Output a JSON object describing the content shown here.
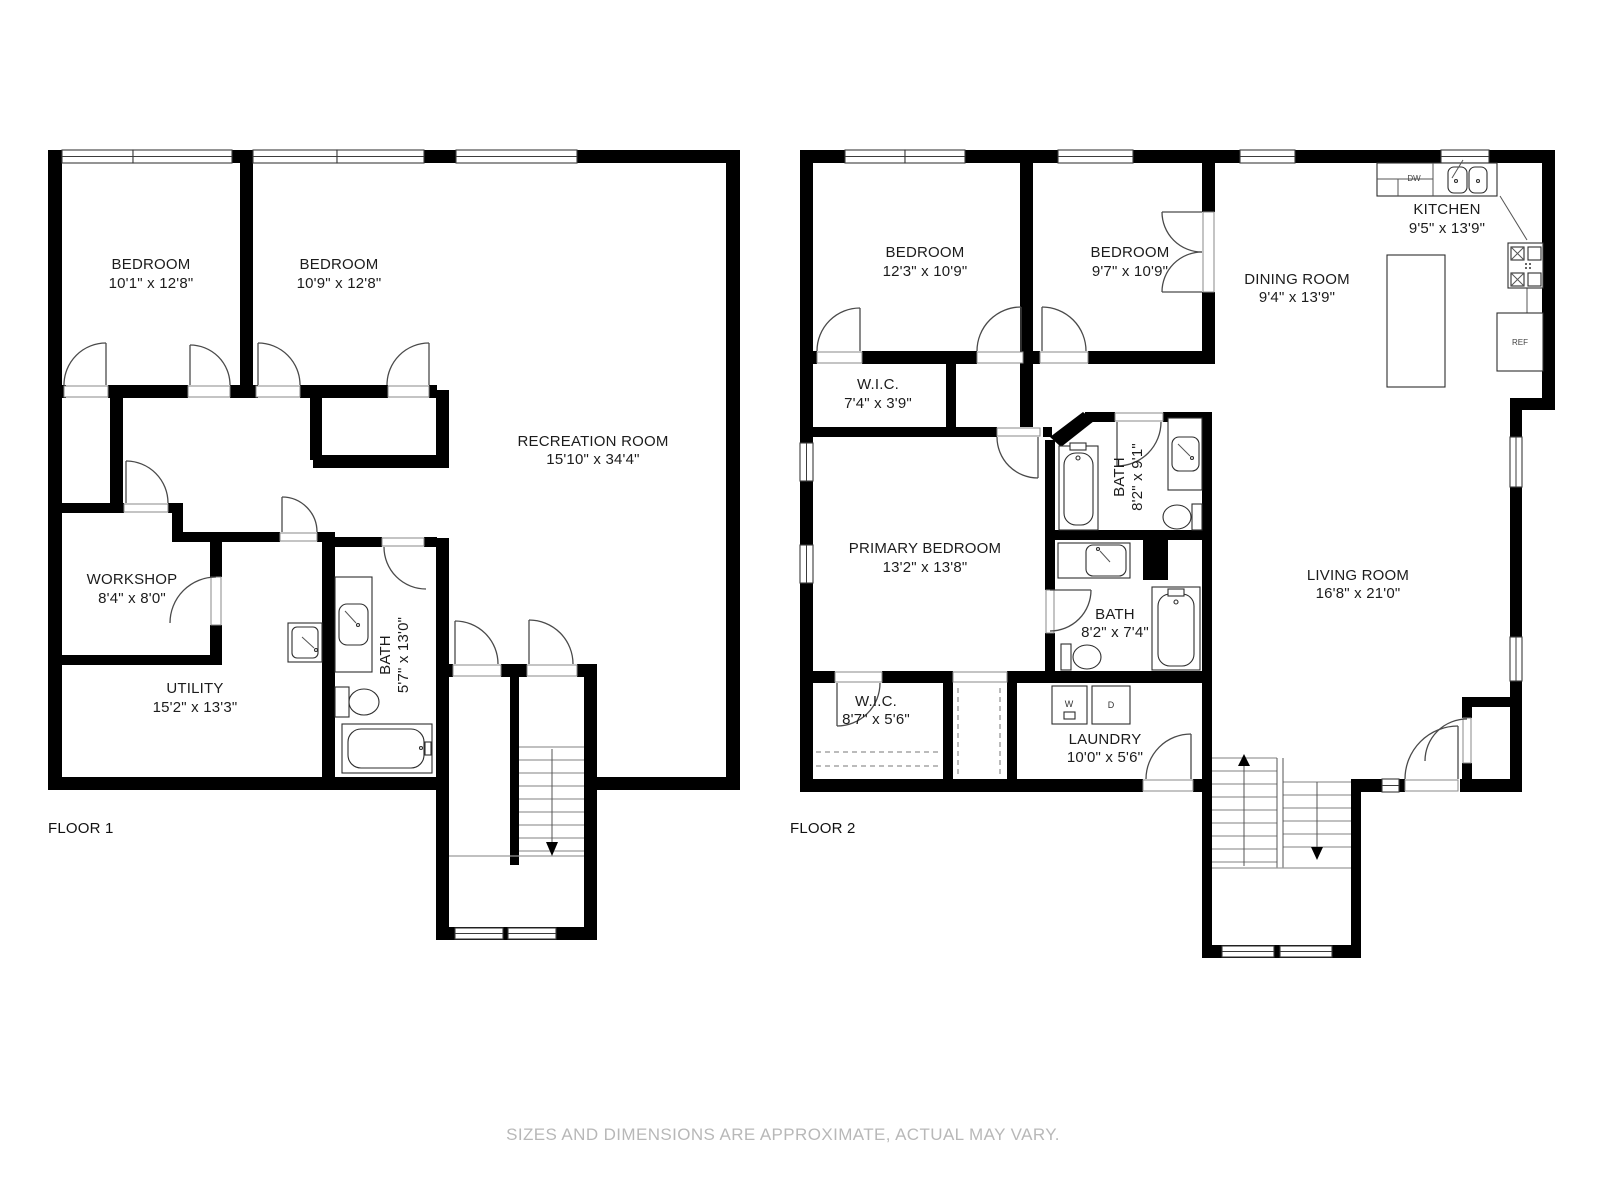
{
  "floor1": {
    "label": "FLOOR 1",
    "rooms": {
      "bedroom1": {
        "name": "BEDROOM",
        "dims": "10'1\" x 12'8\""
      },
      "bedroom2": {
        "name": "BEDROOM",
        "dims": "10'9\" x 12'8\""
      },
      "recreation": {
        "name": "RECREATION ROOM",
        "dims": "15'10\" x 34'4\""
      },
      "workshop": {
        "name": "WORKSHOP",
        "dims": "8'4\" x 8'0\""
      },
      "utility": {
        "name": "UTILITY",
        "dims": "15'2\" x 13'3\""
      },
      "bath": {
        "name": "BATH",
        "dims": "5'7\" x 13'0\""
      }
    }
  },
  "floor2": {
    "label": "FLOOR 2",
    "rooms": {
      "bedroom1": {
        "name": "BEDROOM",
        "dims": "12'3\" x 10'9\""
      },
      "bedroom2": {
        "name": "BEDROOM",
        "dims": "9'7\" x 10'9\""
      },
      "kitchen": {
        "name": "KITCHEN",
        "dims": "9'5\" x 13'9\""
      },
      "dining": {
        "name": "DINING ROOM",
        "dims": "9'4\" x 13'9\""
      },
      "wic1": {
        "name": "W.I.C.",
        "dims": "7'4\" x 3'9\""
      },
      "primary": {
        "name": "PRIMARY BEDROOM",
        "dims": "13'2\" x 13'8\""
      },
      "bath1": {
        "name": "BATH",
        "dims": "8'2\" x 9'1\""
      },
      "bath2": {
        "name": "BATH",
        "dims": "8'2\" x 7'4\""
      },
      "living": {
        "name": "LIVING ROOM",
        "dims": "16'8\" x 21'0\""
      },
      "wic2": {
        "name": "W.I.C.",
        "dims": "8'7\" x 5'6\""
      },
      "laundry": {
        "name": "LAUNDRY",
        "dims": "10'0\" x 5'6\""
      }
    }
  },
  "appliances": {
    "dishwasher": "DW",
    "refrigerator": "REF",
    "washer": "W",
    "dryer": "D"
  },
  "footer": {
    "disclaimer": "SIZES AND DIMENSIONS ARE APPROXIMATE, ACTUAL MAY VARY."
  },
  "colors": {
    "wall": "#000000",
    "door": "#4a4a4a",
    "tread": "#9a9a9a",
    "text": "#1c1c1c",
    "muted": "#b8b8b8"
  }
}
